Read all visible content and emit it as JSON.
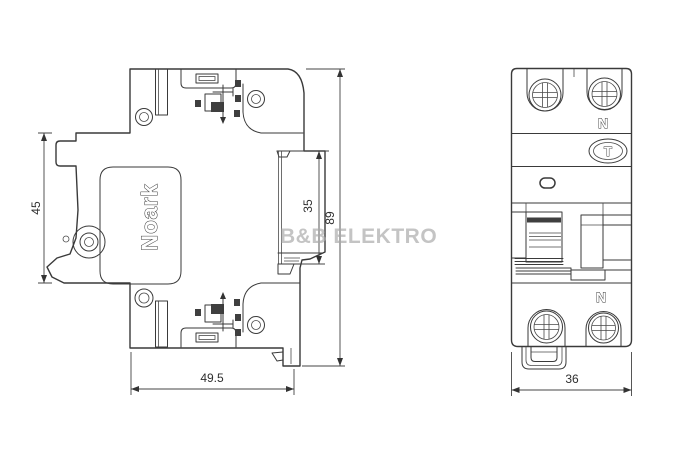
{
  "colors": {
    "background": "#ffffff",
    "line": "#3a3a3a",
    "watermark": "#a9a9a9"
  },
  "watermark": {
    "text": "B&B ELEKTRO"
  },
  "side_view": {
    "brand": "Noark",
    "dim_front_height": "45",
    "dim_bottom_width": "49.5",
    "dim_rail_recess": "35",
    "dim_total_height": "89"
  },
  "front_view": {
    "neutral_top": "N",
    "test_button": "T",
    "neutral_bottom": "N",
    "dim_width": "36"
  }
}
